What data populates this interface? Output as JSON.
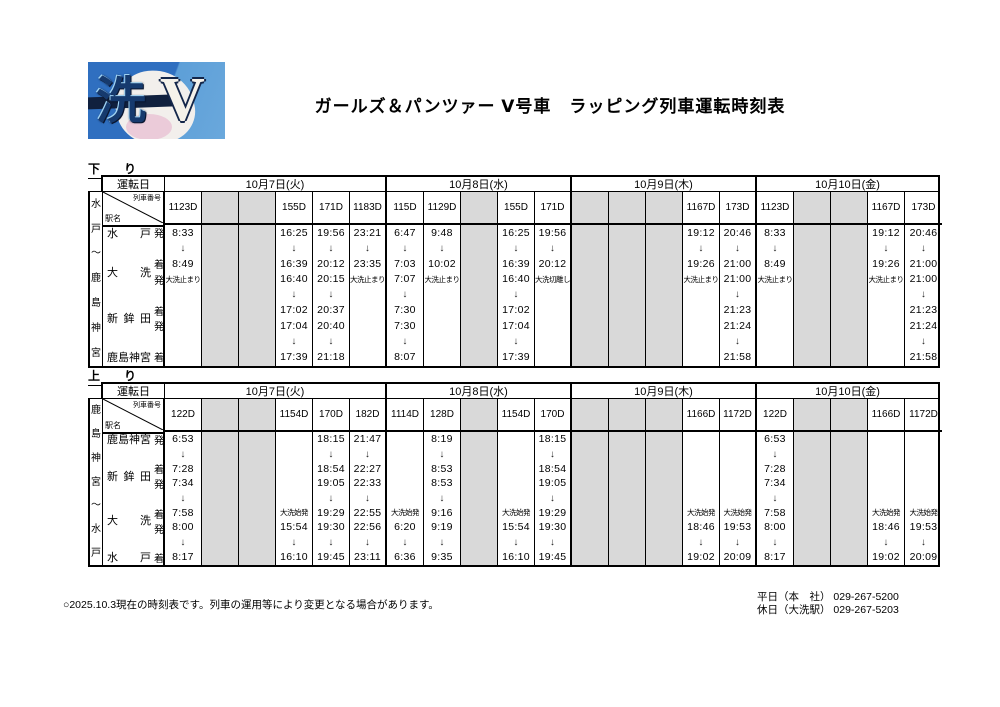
{
  "page": {
    "title": "ガールズ＆パンツァー Ⅴ号車　ラッピング列車運転時刻表"
  },
  "logo": {
    "kanji": "洗",
    "roman": "V"
  },
  "labels": {
    "operating_day": "運転日",
    "train_no": "列車番号",
    "station_name": "駅名"
  },
  "footer": {
    "note": "○2025.10.3現在の時刻表です。列車の運用等により変更となる場合があります。",
    "contacts": [
      "平日（本　社） 029-267-5200",
      "休日（大洗駅） 029-267-5203"
    ]
  },
  "colors": {
    "gray": "#d9d9d9",
    "logo_blue": "#2f6fc0"
  },
  "tables": [
    {
      "direction": "下　り",
      "route": "水戸～鹿島神宮",
      "stations": [
        {
          "name": "水戸",
          "suffix": "発",
          "line": 0,
          "span": 1
        },
        {
          "name": "大洗",
          "suffix": "着発",
          "line": 2,
          "span": 2
        },
        {
          "name": "新鉾田",
          "suffix": "着発",
          "line": 5,
          "span": 2
        },
        {
          "name": "鹿島神宮",
          "suffix": "着",
          "line": 8,
          "span": 1
        }
      ],
      "groups": [
        {
          "date": "10月7日(火)",
          "columns": [
            {
              "train": "1123D",
              "gray": false,
              "cells": [
                "8:33",
                "↓",
                "8:49",
                "大洗止まり",
                "",
                "",
                "",
                "",
                ""
              ]
            },
            {
              "train": "",
              "gray": true,
              "cells": [
                "",
                "",
                "",
                "",
                "",
                "",
                "",
                "",
                ""
              ]
            },
            {
              "train": "",
              "gray": true,
              "cells": [
                "",
                "",
                "",
                "",
                "",
                "",
                "",
                "",
                ""
              ]
            },
            {
              "train": "155D",
              "gray": false,
              "cells": [
                "16:25",
                "↓",
                "16:39",
                "16:40",
                "↓",
                "17:02",
                "17:04",
                "↓",
                "17:39"
              ]
            },
            {
              "train": "171D",
              "gray": false,
              "cells": [
                "19:56",
                "↓",
                "20:12",
                "20:15",
                "↓",
                "20:37",
                "20:40",
                "↓",
                "21:18"
              ]
            },
            {
              "train": "1183D",
              "gray": false,
              "cells": [
                "23:21",
                "↓",
                "23:35",
                "大洗止まり",
                "",
                "",
                "",
                "",
                ""
              ]
            }
          ]
        },
        {
          "date": "10月8日(水)",
          "columns": [
            {
              "train": "115D",
              "gray": false,
              "cells": [
                "6:47",
                "↓",
                "7:03",
                "7:07",
                "↓",
                "7:30",
                "7:30",
                "↓",
                "8:07"
              ]
            },
            {
              "train": "1129D",
              "gray": false,
              "cells": [
                "9:48",
                "↓",
                "10:02",
                "大洗止まり",
                "",
                "",
                "",
                "",
                ""
              ]
            },
            {
              "train": "",
              "gray": true,
              "cells": [
                "",
                "",
                "",
                "",
                "",
                "",
                "",
                "",
                ""
              ]
            },
            {
              "train": "155D",
              "gray": false,
              "cells": [
                "16:25",
                "↓",
                "16:39",
                "16:40",
                "↓",
                "17:02",
                "17:04",
                "↓",
                "17:39"
              ]
            },
            {
              "train": "171D",
              "gray": false,
              "cells": [
                "19:56",
                "↓",
                "20:12",
                "大洗切離し",
                "",
                "",
                "",
                "",
                ""
              ]
            }
          ]
        },
        {
          "date": "10月9日(木)",
          "columns": [
            {
              "train": "",
              "gray": true,
              "cells": [
                "",
                "",
                "",
                "",
                "",
                "",
                "",
                "",
                ""
              ]
            },
            {
              "train": "",
              "gray": true,
              "cells": [
                "",
                "",
                "",
                "",
                "",
                "",
                "",
                "",
                ""
              ]
            },
            {
              "train": "",
              "gray": true,
              "cells": [
                "",
                "",
                "",
                "",
                "",
                "",
                "",
                "",
                ""
              ]
            },
            {
              "train": "1167D",
              "gray": false,
              "cells": [
                "19:12",
                "↓",
                "19:26",
                "大洗止まり",
                "",
                "",
                "",
                "",
                ""
              ]
            },
            {
              "train": "173D",
              "gray": false,
              "cells": [
                "20:46",
                "↓",
                "21:00",
                "21:00",
                "↓",
                "21:23",
                "21:24",
                "↓",
                "21:58"
              ]
            }
          ]
        },
        {
          "date": "10月10日(金)",
          "columns": [
            {
              "train": "1123D",
              "gray": false,
              "cells": [
                "8:33",
                "↓",
                "8:49",
                "大洗止まり",
                "",
                "",
                "",
                "",
                ""
              ]
            },
            {
              "train": "",
              "gray": true,
              "cells": [
                "",
                "",
                "",
                "",
                "",
                "",
                "",
                "",
                ""
              ]
            },
            {
              "train": "",
              "gray": true,
              "cells": [
                "",
                "",
                "",
                "",
                "",
                "",
                "",
                "",
                ""
              ]
            },
            {
              "train": "1167D",
              "gray": false,
              "cells": [
                "19:12",
                "↓",
                "19:26",
                "大洗止まり",
                "",
                "",
                "",
                "",
                ""
              ]
            },
            {
              "train": "173D",
              "gray": false,
              "cells": [
                "20:46",
                "↓",
                "21:00",
                "21:00",
                "↓",
                "21:23",
                "21:24",
                "↓",
                "21:58"
              ]
            }
          ]
        }
      ]
    },
    {
      "direction": "上　り",
      "route": "鹿島神宮～水戸",
      "stations": [
        {
          "name": "鹿島神宮",
          "suffix": "発",
          "line": 0,
          "span": 1
        },
        {
          "name": "新鉾田",
          "suffix": "着発",
          "line": 2,
          "span": 2
        },
        {
          "name": "大洗",
          "suffix": "着発",
          "line": 5,
          "span": 2
        },
        {
          "name": "水戸",
          "suffix": "着",
          "line": 8,
          "span": 1
        }
      ],
      "groups": [
        {
          "date": "10月7日(火)",
          "columns": [
            {
              "train": "122D",
              "gray": false,
              "cells": [
                "6:53",
                "↓",
                "7:28",
                "7:34",
                "↓",
                "7:58",
                "8:00",
                "↓",
                "8:17"
              ]
            },
            {
              "train": "",
              "gray": true,
              "cells": [
                "",
                "",
                "",
                "",
                "",
                "",
                "",
                "",
                ""
              ]
            },
            {
              "train": "",
              "gray": true,
              "cells": [
                "",
                "",
                "",
                "",
                "",
                "",
                "",
                "",
                ""
              ]
            },
            {
              "train": "1154D",
              "gray": false,
              "cells": [
                "",
                "",
                "",
                "",
                "",
                "大洗始発",
                "15:54",
                "↓",
                "16:10"
              ]
            },
            {
              "train": "170D",
              "gray": false,
              "cells": [
                "18:15",
                "↓",
                "18:54",
                "19:05",
                "↓",
                "19:29",
                "19:30",
                "↓",
                "19:45"
              ]
            },
            {
              "train": "182D",
              "gray": false,
              "cells": [
                "21:47",
                "↓",
                "22:27",
                "22:33",
                "↓",
                "22:55",
                "22:56",
                "↓",
                "23:11"
              ]
            }
          ]
        },
        {
          "date": "10月8日(水)",
          "columns": [
            {
              "train": "1114D",
              "gray": false,
              "cells": [
                "",
                "",
                "",
                "",
                "",
                "大洗始発",
                "6:20",
                "↓",
                "6:36"
              ]
            },
            {
              "train": "128D",
              "gray": false,
              "cells": [
                "8:19",
                "↓",
                "8:53",
                "8:53",
                "↓",
                "9:16",
                "9:19",
                "↓",
                "9:35"
              ]
            },
            {
              "train": "",
              "gray": true,
              "cells": [
                "",
                "",
                "",
                "",
                "",
                "",
                "",
                "",
                ""
              ]
            },
            {
              "train": "1154D",
              "gray": false,
              "cells": [
                "",
                "",
                "",
                "",
                "",
                "大洗始発",
                "15:54",
                "↓",
                "16:10"
              ]
            },
            {
              "train": "170D",
              "gray": false,
              "cells": [
                "18:15",
                "↓",
                "18:54",
                "19:05",
                "↓",
                "19:29",
                "19:30",
                "↓",
                "19:45"
              ]
            }
          ]
        },
        {
          "date": "10月9日(木)",
          "columns": [
            {
              "train": "",
              "gray": true,
              "cells": [
                "",
                "",
                "",
                "",
                "",
                "",
                "",
                "",
                ""
              ]
            },
            {
              "train": "",
              "gray": true,
              "cells": [
                "",
                "",
                "",
                "",
                "",
                "",
                "",
                "",
                ""
              ]
            },
            {
              "train": "",
              "gray": true,
              "cells": [
                "",
                "",
                "",
                "",
                "",
                "",
                "",
                "",
                ""
              ]
            },
            {
              "train": "1166D",
              "gray": false,
              "cells": [
                "",
                "",
                "",
                "",
                "",
                "大洗始発",
                "18:46",
                "↓",
                "19:02"
              ]
            },
            {
              "train": "1172D",
              "gray": false,
              "cells": [
                "",
                "",
                "",
                "",
                "",
                "大洗始発",
                "19:53",
                "↓",
                "20:09"
              ]
            }
          ]
        },
        {
          "date": "10月10日(金)",
          "columns": [
            {
              "train": "122D",
              "gray": false,
              "cells": [
                "6:53",
                "↓",
                "7:28",
                "7:34",
                "↓",
                "7:58",
                "8:00",
                "↓",
                "8:17"
              ]
            },
            {
              "train": "",
              "gray": true,
              "cells": [
                "",
                "",
                "",
                "",
                "",
                "",
                "",
                "",
                ""
              ]
            },
            {
              "train": "",
              "gray": true,
              "cells": [
                "",
                "",
                "",
                "",
                "",
                "",
                "",
                "",
                ""
              ]
            },
            {
              "train": "1166D",
              "gray": false,
              "cells": [
                "",
                "",
                "",
                "",
                "",
                "大洗始発",
                "18:46",
                "↓",
                "19:02"
              ]
            },
            {
              "train": "1172D",
              "gray": false,
              "cells": [
                "",
                "",
                "",
                "",
                "",
                "大洗始発",
                "19:53",
                "↓",
                "20:09"
              ]
            }
          ]
        }
      ]
    }
  ]
}
